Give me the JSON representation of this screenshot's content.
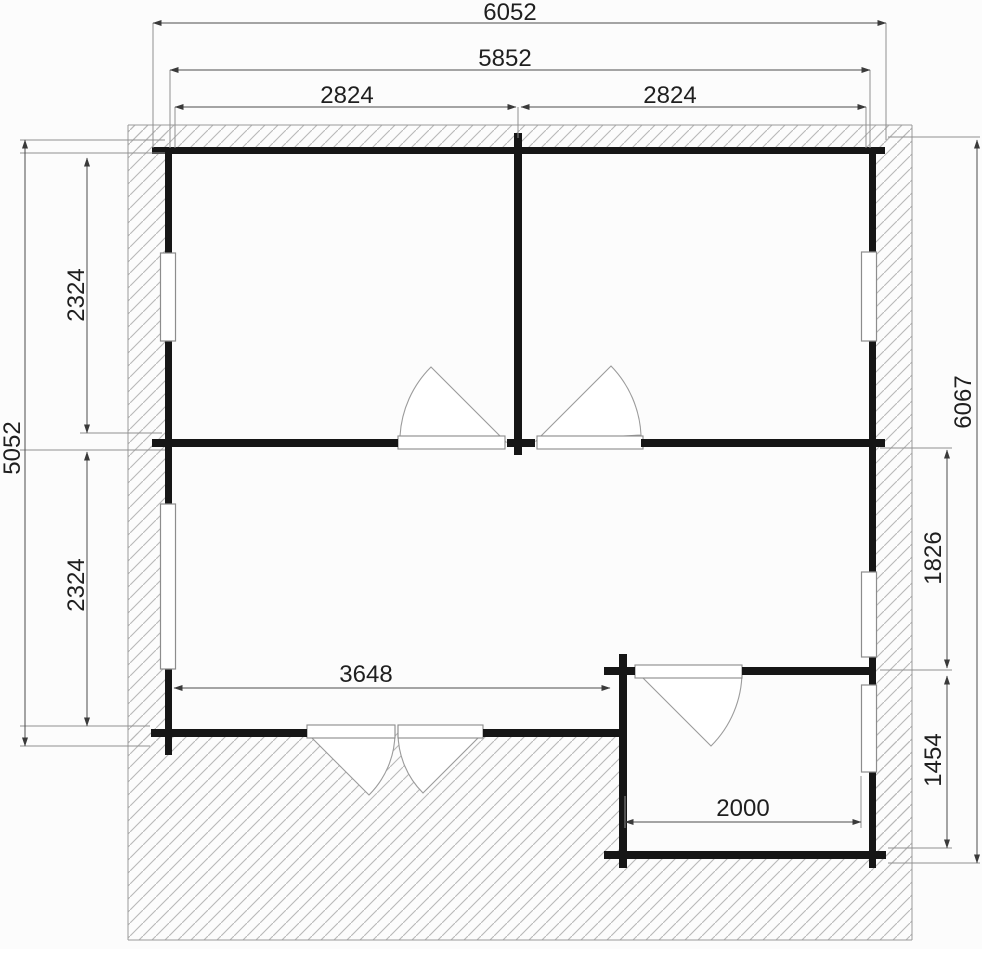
{
  "drawing": {
    "type": "floor-plan",
    "wall_hatch_color": "#b8b8b8",
    "wall_line_color": "#161616",
    "dim_line_color": "#4d4d4d"
  },
  "dims": {
    "overall_width": "6052",
    "inner_width": "5852",
    "room_left_width": "2824",
    "room_right_width": "2824",
    "left_total_height": "5052",
    "left_upper_room_height": "2324",
    "left_lower_room_height": "2324",
    "right_total_height": "6067",
    "right_upper_segment": "1826",
    "right_lower_segment": "1454",
    "living_room_width": "3648",
    "annex_width": "2000"
  }
}
